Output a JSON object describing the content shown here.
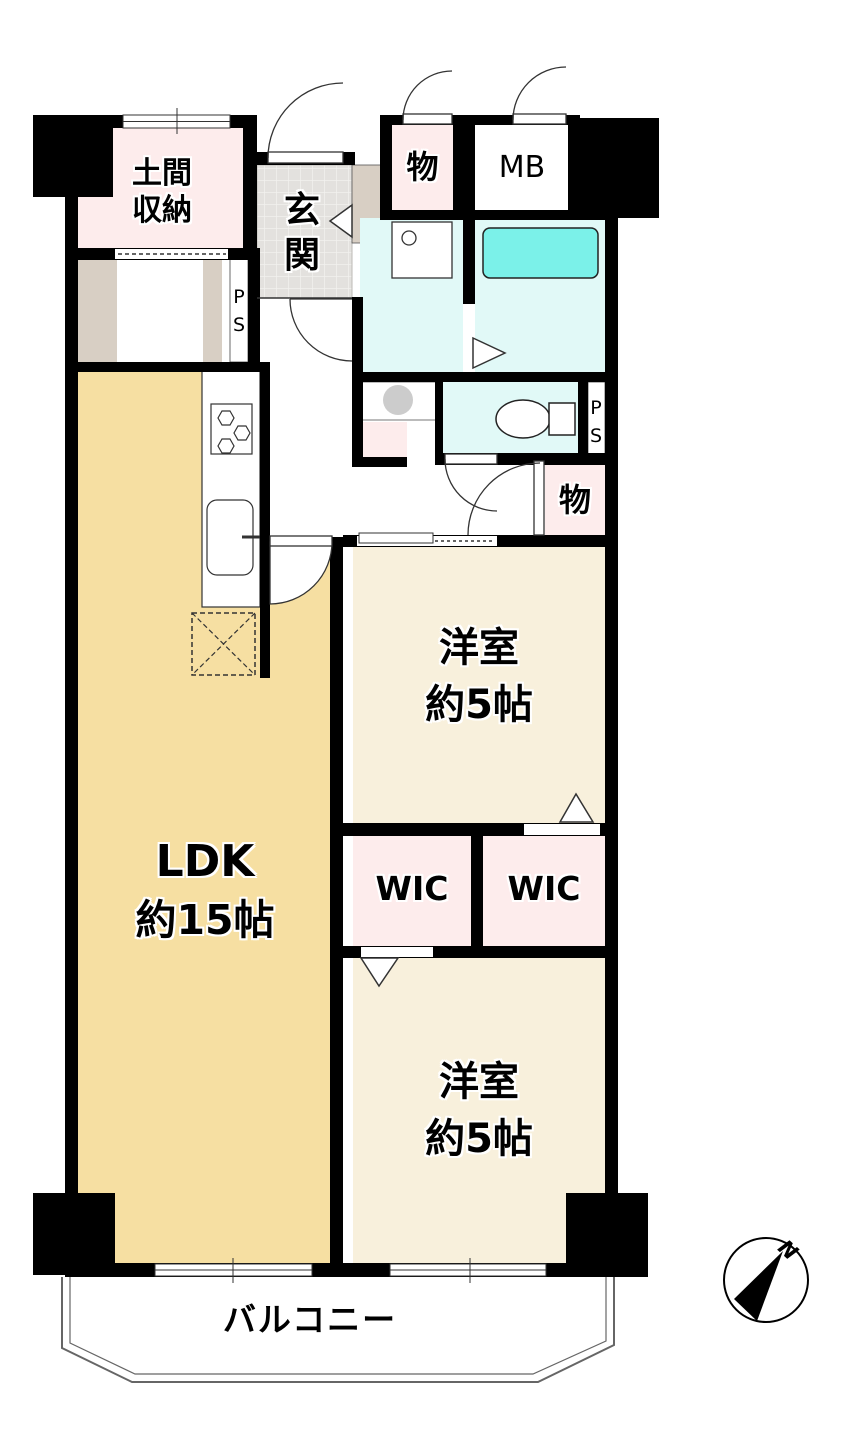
{
  "plan": {
    "rooms": {
      "doma": {
        "line1": "土間",
        "line2": "収納"
      },
      "genkan": {
        "chars": [
          "玄",
          "関"
        ]
      },
      "storage_top": {
        "label": "物"
      },
      "mb": {
        "label": "MB"
      },
      "ps_top": {
        "chars": [
          "P",
          "S"
        ]
      },
      "ps_right": {
        "chars": [
          "P",
          "S"
        ]
      },
      "storage_mid": {
        "label": "物"
      },
      "bedroom1": {
        "name": "洋室",
        "size": "約5帖"
      },
      "wic_left": {
        "label": "WIC"
      },
      "wic_right": {
        "label": "WIC"
      },
      "bedroom2": {
        "name": "洋室",
        "size": "約5帖"
      },
      "ldk": {
        "name": "LDK",
        "size": "約15帖"
      },
      "balcony": {
        "label": "バルコニー"
      }
    },
    "compass": {
      "north_label": "N"
    },
    "colors": {
      "wall": "#000000",
      "ldk_floor": "#f6dfa2",
      "bedroom_floor": "#f8f0dc",
      "closet_pink": "#fdecec",
      "wet_area": "#e1f9f7",
      "bathtub": "#7bf1e9",
      "genkan_tile": "#e3e1de",
      "cabinet": "#d8cfc4",
      "washer": "#cccccc"
    }
  }
}
